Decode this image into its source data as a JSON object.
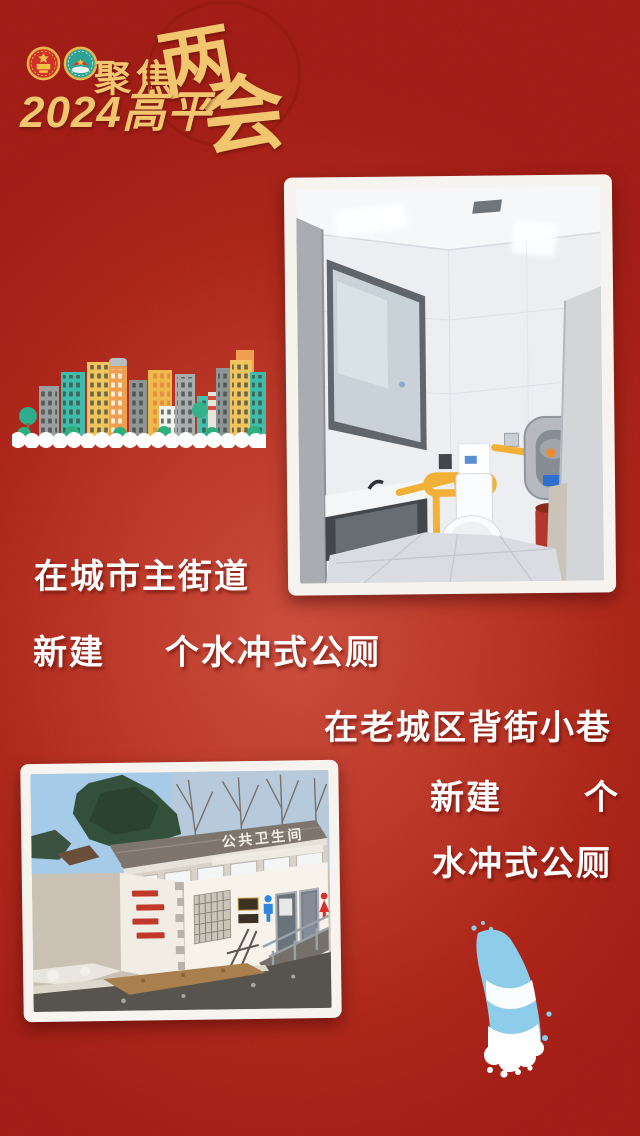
{
  "poster": {
    "header": {
      "focus_label": "聚焦",
      "calligraphy_char_1": "两",
      "calligraphy_char_2": "会",
      "edition_label": "2024高平",
      "emblem_icons": [
        "national-emblem-icon",
        "cppcc-emblem-icon"
      ]
    },
    "messages": {
      "street": {
        "line1": "在城市主街道",
        "line2_prefix": "新建",
        "line2_suffix": "个水冲式公厕"
      },
      "alley": {
        "line1": "在老城区背街小巷",
        "line2_prefix": "新建",
        "line2_suffix": "个",
        "line3": "水冲式公厕"
      }
    },
    "photo_exterior": {
      "sign_text": "公共卫生间"
    },
    "colors": {
      "background_red_dark": "#971b15",
      "background_red_light": "#c5483a",
      "gold": "#f2c66f",
      "headline_white": "#ffffff",
      "splash_blue": "#8ecdea",
      "skyline_teal": "#3fbcab",
      "skyline_yellow": "#f0c55e",
      "skyline_orange": "#ef9f4d",
      "grab_bar_yellow": "#f2b036"
    }
  }
}
